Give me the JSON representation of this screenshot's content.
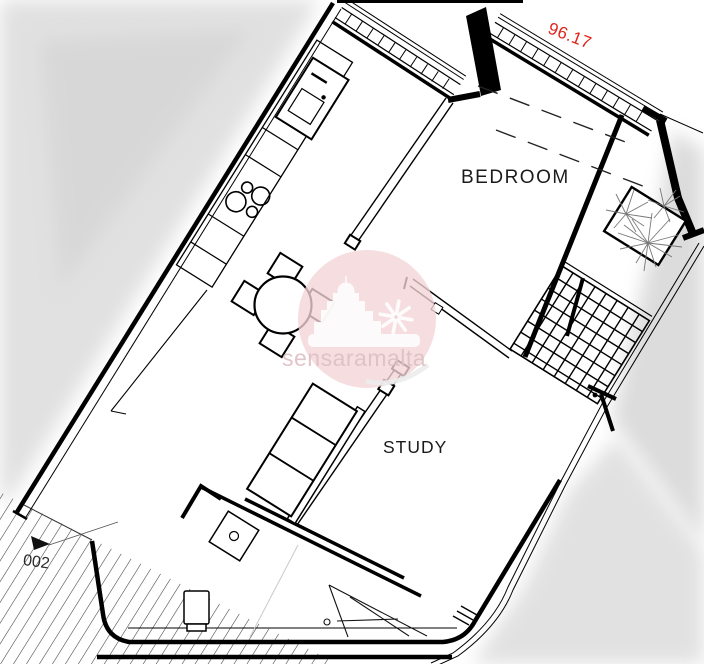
{
  "plan": {
    "rooms": [
      {
        "label": "BEDROOM"
      },
      {
        "label": "STUDY"
      }
    ],
    "area_label": "96.17",
    "unit_label": "002",
    "watermark": {
      "text": "sensaramalta"
    },
    "colors": {
      "line": "#000000",
      "area_red": "#e2231a",
      "watermark_pink": "#f2d4d7",
      "watermark_text": "#dfc0c3",
      "scan_shadow": "#d9d9d9",
      "hatch": "#3c3c3c"
    }
  }
}
